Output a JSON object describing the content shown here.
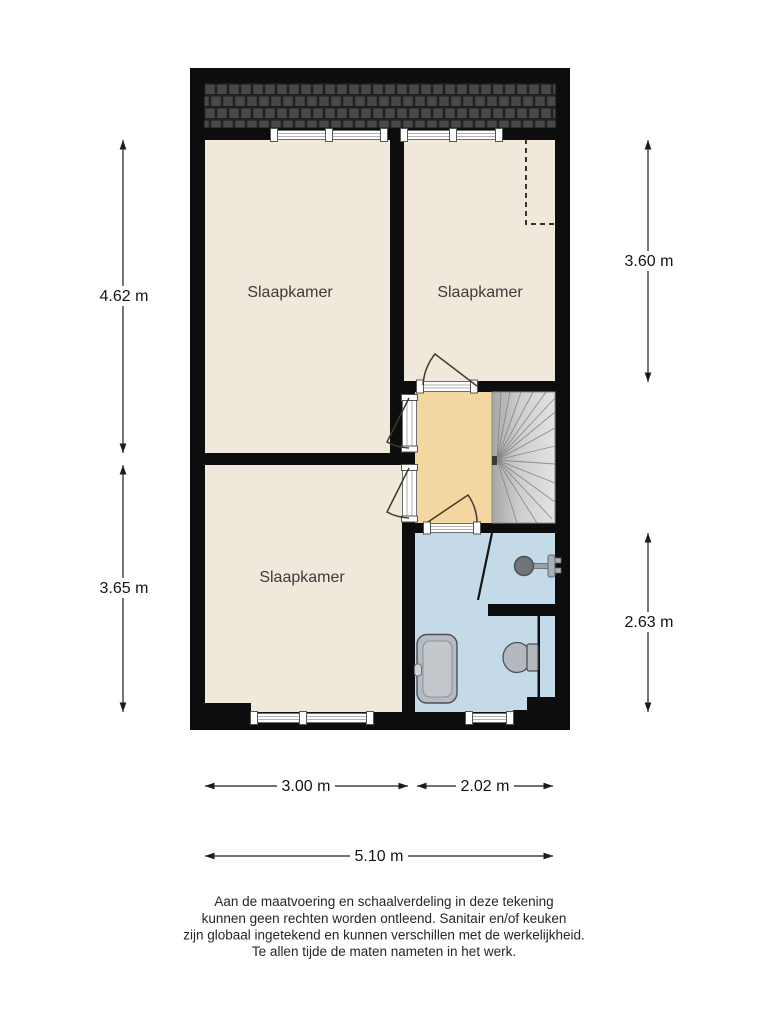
{
  "plan": {
    "type": "floor-plan",
    "rooms": [
      {
        "id": "bedroom-top-left",
        "label": "Slaapkamer"
      },
      {
        "id": "bedroom-top-right",
        "label": "Slaapkamer"
      },
      {
        "id": "bedroom-bottom-left",
        "label": "Slaapkamer"
      }
    ],
    "features": [
      "roof-tiles",
      "winder-staircase",
      "landing",
      "bathroom",
      "shower-head",
      "toilet",
      "shower-tray",
      "windows",
      "doors",
      "roof-slope-dashed-line"
    ]
  },
  "dimensions": {
    "left_top": "4.62 m",
    "left_bottom": "3.65 m",
    "right_top": "3.60 m",
    "right_bottom": "2.63 m",
    "bottom_left": "3.00 m",
    "bottom_right": "2.02 m",
    "bottom_total": "5.10 m"
  },
  "disclaimer": {
    "lines": [
      "Aan de maatvoering en schaalverdeling in deze tekening",
      "kunnen geen rechten worden ontleend. Sanitair en/of keuken",
      "zijn globaal ingetekend en kunnen verschillen met de werkelijkheid.",
      "Te allen tijde de maten nameten in het werk."
    ]
  },
  "colors": {
    "wall": "#0d0d0d",
    "floor": "#efe8db",
    "landing": "#f4d6a0",
    "bathroom": "#c5dae8",
    "stairs_dark": "#a6a6a6",
    "stairs_light": "#e3e3e3",
    "roof_tile": "#484848",
    "roof_bg": "#2b2b2b",
    "fixture": "#b2b8bd",
    "dimension_line": "#1c1c1c"
  }
}
